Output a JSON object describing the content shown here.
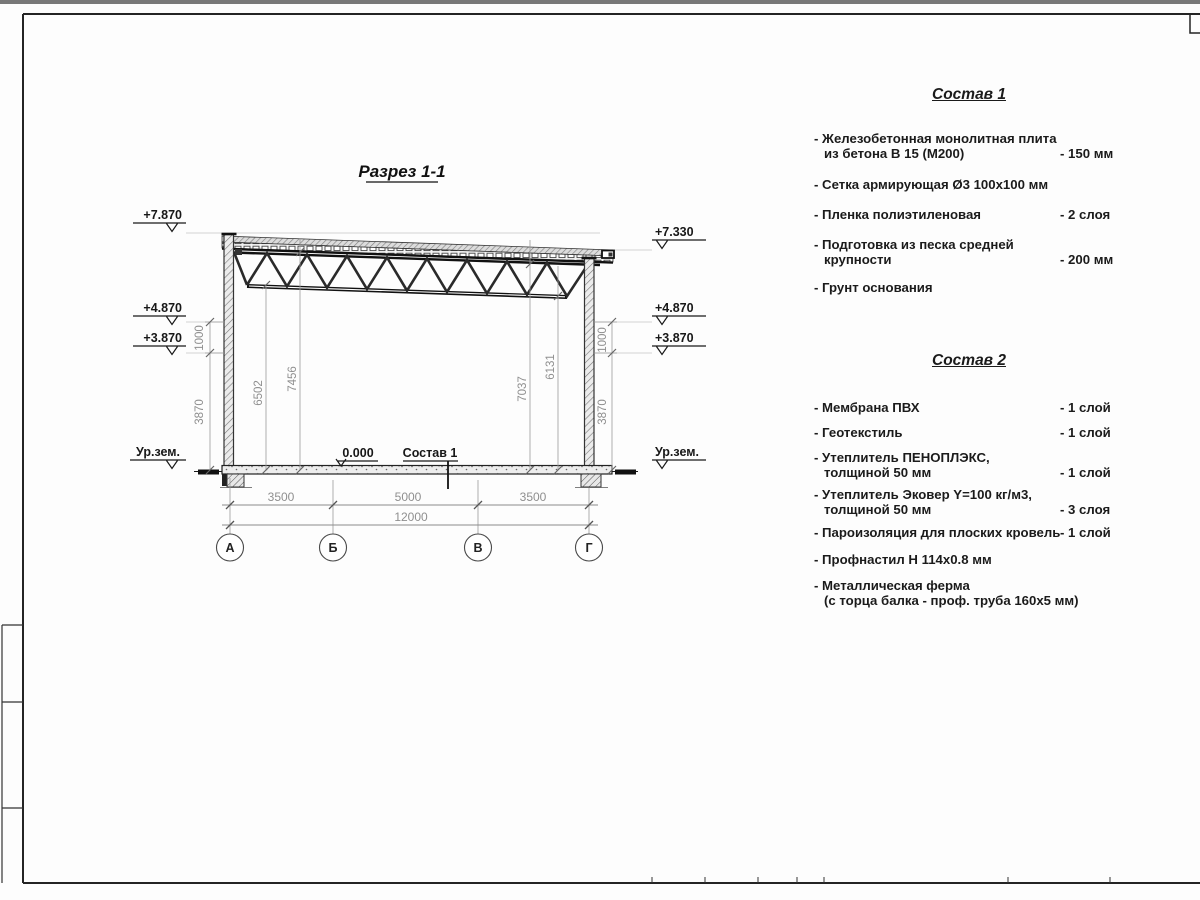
{
  "drawing": {
    "title": "Разрез 1-1",
    "elev": {
      "l1": "+7.870",
      "l2": "+4.870",
      "l3": "+3.870",
      "l4": "Ур.зем.",
      "r1": "+7.330",
      "r2": "+4.870",
      "r3": "+3.870",
      "r4": "Ур.зем."
    },
    "vdims": {
      "d6502": "6502",
      "d7456": "7456",
      "d7037": "7037",
      "d6131": "6131"
    },
    "sdims": {
      "left_1000": "1000",
      "left_3870": "3870",
      "right_1000": "1000",
      "right_3870": "3870"
    },
    "bdims": {
      "b1": "3500",
      "b2": "5000",
      "b3": "3500",
      "total": "12000"
    },
    "axes": {
      "a": "А",
      "b": "Б",
      "v": "В",
      "g": "Г"
    },
    "zero_mark": "0.000",
    "floor_label": "Состав 1"
  },
  "sostav1": {
    "title": "Состав 1",
    "items": [
      {
        "line1": "- Железобетонная  монолитная плита",
        "line2": "из бетона В 15 (М200)",
        "value": "- 150 мм"
      },
      {
        "line1": "- Сетка армирующая Ø3 100х100 мм",
        "line2": "",
        "value": ""
      },
      {
        "line1": "- Пленка полиэтиленовая",
        "line2": "",
        "value": "-  2 слоя"
      },
      {
        "line1": "- Подготовка из песка средней",
        "line2": "крупности",
        "value": "- 200 мм"
      },
      {
        "line1": "- Грунт основания",
        "line2": "",
        "value": ""
      }
    ]
  },
  "sostav2": {
    "title": "Состав 2",
    "items": [
      {
        "line1": "- Мембрана ПВХ",
        "line2": "",
        "value": "- 1 слой"
      },
      {
        "line1": "- Геотекстиль",
        "line2": "",
        "value": "- 1 слой"
      },
      {
        "line1": "- Утеплитель ПЕНОПЛЭКС,",
        "line2": "толщиной 50 мм",
        "value": "- 1 слой"
      },
      {
        "line1": "- Утеплитель Эковер Y=100 кг/м3,",
        "line2": "толщиной 50 мм",
        "value": "- 3 слоя"
      },
      {
        "line1": "- Пароизоляция для плоских кровель",
        "line2": "",
        "value": "- 1 слой"
      },
      {
        "line1": "- Профнастил Н 114х0.8 мм",
        "line2": "",
        "value": ""
      },
      {
        "line1": "- Металлическая ферма",
        "line2": "(с торца балка - проф. труба 160х5 мм)",
        "value": ""
      }
    ]
  }
}
